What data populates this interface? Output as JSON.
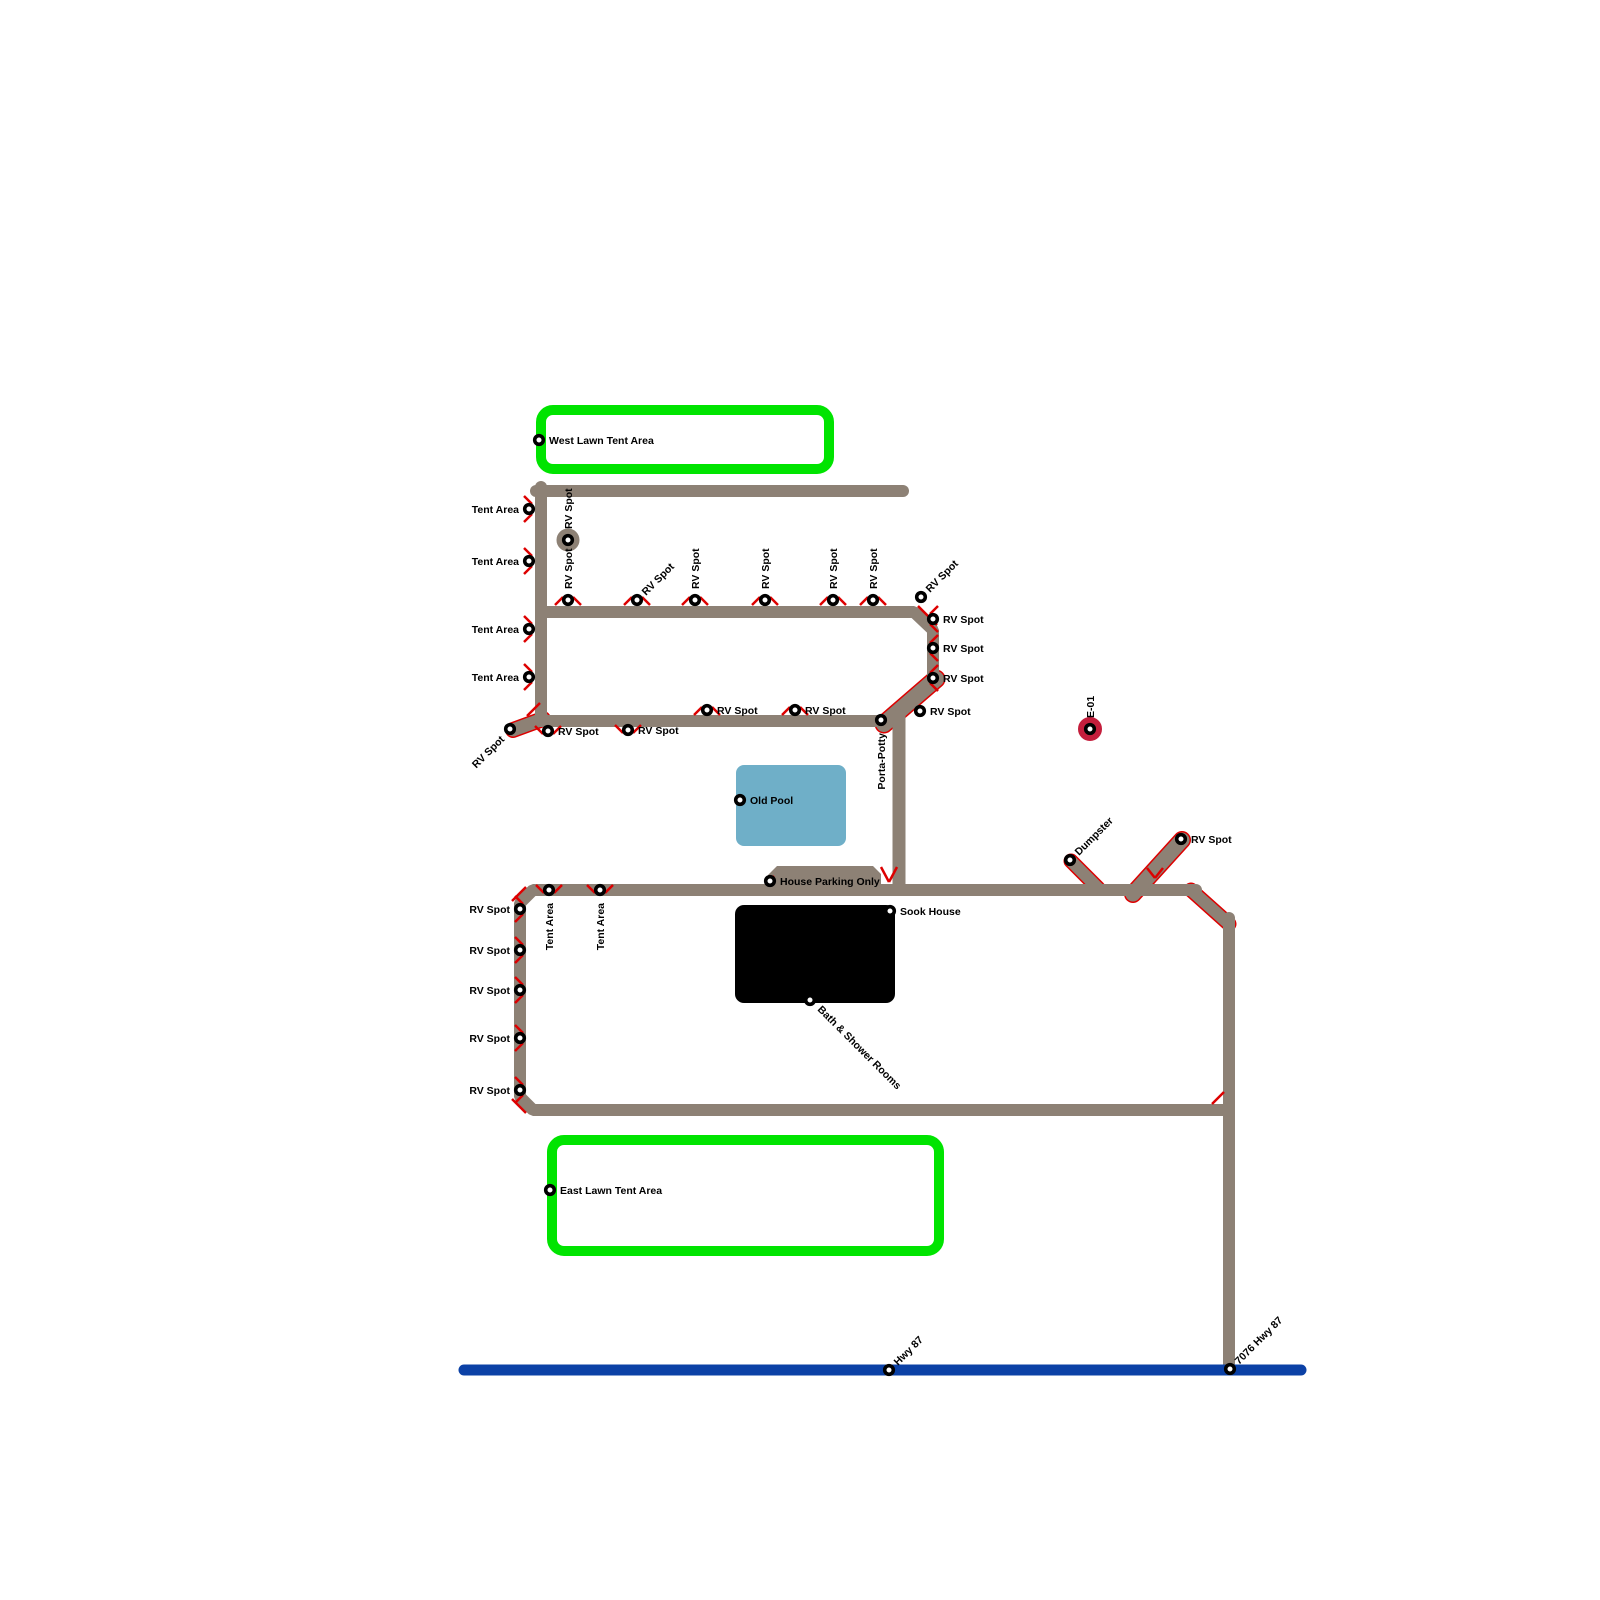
{
  "map": {
    "title": "Campground Site Map",
    "background": "#ffffff",
    "colors": {
      "road": "#8d8175",
      "casing": "#dd0000",
      "highway": "#0b41a6",
      "lawn_border": "#00e400",
      "lawn_fill": "#ffffff",
      "pool": "#6fafc8",
      "building": "#000000",
      "node_ring": "#000000",
      "node_fill": "#ffffff",
      "marker_red": "#c41e3c",
      "label": "#000000"
    },
    "label_font_px": 10.5,
    "areas": [
      {
        "name": "west-lawn-tent-area",
        "type": "lawn",
        "x": 541,
        "y": 410,
        "w": 288,
        "h": 59,
        "stroke_w": 10,
        "rx": 12
      },
      {
        "name": "east-lawn-tent-area",
        "type": "lawn",
        "x": 552,
        "y": 1140,
        "w": 387,
        "h": 111,
        "stroke_w": 10,
        "rx": 12
      },
      {
        "name": "old-pool",
        "type": "pool",
        "x": 736,
        "y": 765,
        "w": 110,
        "h": 81,
        "rx": 8
      },
      {
        "name": "sook-house-building",
        "type": "building",
        "x": 735,
        "y": 905,
        "w": 160,
        "h": 98,
        "rx": 9
      }
    ],
    "road_polys": [
      {
        "name": "house-parking-pad",
        "points": [
          [
            768,
            891
          ],
          [
            768,
            875
          ],
          [
            777,
            866
          ],
          [
            873,
            866
          ],
          [
            881,
            874
          ],
          [
            881,
            891
          ]
        ]
      }
    ],
    "roads": [
      {
        "name": "upper-top-road",
        "points": [
          [
            536,
            491
          ],
          [
            903,
            491
          ]
        ],
        "w": 12,
        "cased": false
      },
      {
        "name": "upper-left-road",
        "points": [
          [
            541,
            487
          ],
          [
            541,
            721
          ]
        ],
        "w": 12,
        "cased": false
      },
      {
        "name": "rv-row-road",
        "points": [
          [
            541,
            612
          ],
          [
            914,
            612
          ],
          [
            933,
            630
          ],
          [
            933,
            680
          ]
        ],
        "w": 12,
        "cased": false
      },
      {
        "name": "upper-bottom-road",
        "points": [
          [
            536,
            721
          ],
          [
            886,
            721
          ]
        ],
        "w": 12,
        "cased": false
      },
      {
        "name": "sw-stub-road",
        "points": [
          [
            543,
            719
          ],
          [
            513,
            730
          ]
        ],
        "w": 13,
        "cased": true
      },
      {
        "name": "porta-junction-diagonal",
        "points": [
          [
            884,
            724
          ],
          [
            936,
            679
          ]
        ],
        "w": 16,
        "cased": true
      },
      {
        "name": "porta-down-road",
        "points": [
          [
            899,
            716
          ],
          [
            899,
            889
          ]
        ],
        "w": 13,
        "cased": false
      },
      {
        "name": "lower-loop-road",
        "points": [
          [
            1196,
            890
          ],
          [
            533,
            890
          ],
          [
            520,
            903
          ],
          [
            520,
            1097
          ],
          [
            533,
            1110
          ],
          [
            1226,
            1110
          ]
        ],
        "w": 12,
        "cased": false
      },
      {
        "name": "east-corner-diagonal",
        "points": [
          [
            1191,
            890
          ],
          [
            1229,
            924
          ]
        ],
        "w": 12,
        "cased": true
      },
      {
        "name": "east-vertical-road",
        "points": [
          [
            1229,
            918
          ],
          [
            1229,
            1368
          ]
        ],
        "w": 12,
        "cased": false
      },
      {
        "name": "dumpster-spur",
        "points": [
          [
            1098,
            888
          ],
          [
            1071,
            861
          ]
        ],
        "w": 12,
        "cased": true
      },
      {
        "name": "rv-spur",
        "points": [
          [
            1133,
            894
          ],
          [
            1182,
            840
          ]
        ],
        "w": 15,
        "cased": true
      },
      {
        "name": "hwy-87-line",
        "points": [
          [
            464,
            1370
          ],
          [
            1301,
            1370
          ]
        ],
        "w": 11,
        "cased": false,
        "color": "highway"
      }
    ],
    "accents": [
      [
        [
          881,
          867
        ],
        [
          889,
          882
        ]
      ],
      [
        [
          889,
          882
        ],
        [
          897,
          867
        ]
      ],
      [
        [
          1147,
          868
        ],
        [
          1155,
          878
        ]
      ],
      [
        [
          1155,
          878
        ],
        [
          1163,
          868
        ]
      ],
      [
        [
          512,
          901
        ],
        [
          526,
          887
        ]
      ],
      [
        [
          512,
          1099
        ],
        [
          526,
          1113
        ]
      ],
      [
        [
          918,
          606
        ],
        [
          937,
          625
        ]
      ],
      [
        [
          1212,
          1104
        ],
        [
          1224,
          1092
        ]
      ],
      [
        [
          527,
          716
        ],
        [
          540,
          703
        ]
      ],
      [
        [
          766,
          884
        ],
        [
          774,
          876
        ]
      ]
    ],
    "nodes": [
      {
        "label": "West Lawn Tent Area",
        "x": 539,
        "y": 440,
        "lp": "right",
        "style": "default"
      },
      {
        "label": "Tent Area",
        "x": 529,
        "y": 509,
        "lp": "left",
        "style": "default",
        "ticks": "left"
      },
      {
        "label": "Tent Area",
        "x": 529,
        "y": 561,
        "lp": "left",
        "style": "default",
        "ticks": "left"
      },
      {
        "label": "Tent Area",
        "x": 529,
        "y": 629,
        "lp": "left",
        "style": "default",
        "ticks": "left"
      },
      {
        "label": "Tent Area",
        "x": 529,
        "y": 677,
        "lp": "left",
        "style": "default",
        "ticks": "left"
      },
      {
        "label": "RV Spot",
        "x": 568,
        "y": 540,
        "lp": "up",
        "style": "ring-road"
      },
      {
        "label": "RV Spot",
        "x": 568,
        "y": 600,
        "lp": "up",
        "style": "default",
        "ticks": "top"
      },
      {
        "label": "RV Spot",
        "x": 637,
        "y": 600,
        "lp": "diag-ur",
        "style": "default",
        "ticks": "top"
      },
      {
        "label": "RV Spot",
        "x": 695,
        "y": 600,
        "lp": "up",
        "style": "default",
        "ticks": "top"
      },
      {
        "label": "RV Spot",
        "x": 765,
        "y": 600,
        "lp": "up",
        "style": "default",
        "ticks": "top"
      },
      {
        "label": "RV Spot",
        "x": 833,
        "y": 600,
        "lp": "up",
        "style": "default",
        "ticks": "top"
      },
      {
        "label": "RV Spot",
        "x": 873,
        "y": 600,
        "lp": "up",
        "style": "default",
        "ticks": "top"
      },
      {
        "label": "RV Spot",
        "x": 921,
        "y": 597,
        "lp": "diag-ur",
        "style": "default"
      },
      {
        "label": "RV Spot",
        "x": 933,
        "y": 619,
        "lp": "right",
        "style": "default",
        "ticks": "right"
      },
      {
        "label": "RV Spot",
        "x": 933,
        "y": 648,
        "lp": "right",
        "style": "default",
        "ticks": "right"
      },
      {
        "label": "RV Spot",
        "x": 933,
        "y": 678,
        "lp": "right",
        "style": "default",
        "ticks": "right"
      },
      {
        "label": "RV Spot",
        "x": 920,
        "y": 711,
        "lp": "right",
        "style": "default"
      },
      {
        "label": "RV Spot",
        "x": 795,
        "y": 710,
        "lp": "right",
        "style": "default",
        "ticks": "top"
      },
      {
        "label": "RV Spot",
        "x": 707,
        "y": 710,
        "lp": "right",
        "style": "default",
        "ticks": "top"
      },
      {
        "label": "Porta-Potty",
        "x": 881,
        "y": 720,
        "lp": "down",
        "style": "default"
      },
      {
        "label": "RV Spot",
        "x": 628,
        "y": 730,
        "lp": "right",
        "style": "default",
        "ticks": "bottom"
      },
      {
        "label": "RV Spot",
        "x": 548,
        "y": 731,
        "lp": "right",
        "style": "default",
        "ticks": "bottom"
      },
      {
        "label": "RV Spot",
        "x": 510,
        "y": 729,
        "lp": "diag-dl",
        "style": "default"
      },
      {
        "label": "E-01",
        "x": 1090,
        "y": 729,
        "lp": "up",
        "style": "ring-red"
      },
      {
        "label": "Old Pool",
        "x": 740,
        "y": 800,
        "lp": "right",
        "style": "default"
      },
      {
        "label": "House Parking Only",
        "x": 770,
        "y": 881,
        "lp": "right",
        "style": "default"
      },
      {
        "label": "Tent Area",
        "x": 549,
        "y": 890,
        "lp": "down",
        "style": "default",
        "ticks": "bottom"
      },
      {
        "label": "Tent Area",
        "x": 600,
        "y": 890,
        "lp": "down",
        "style": "default",
        "ticks": "bottom"
      },
      {
        "label": "RV Spot",
        "x": 520,
        "y": 909,
        "lp": "left",
        "style": "default",
        "ticks": "left"
      },
      {
        "label": "RV Spot",
        "x": 520,
        "y": 950,
        "lp": "left",
        "style": "default",
        "ticks": "left"
      },
      {
        "label": "RV Spot",
        "x": 520,
        "y": 990,
        "lp": "left",
        "style": "default",
        "ticks": "left"
      },
      {
        "label": "RV Spot",
        "x": 520,
        "y": 1038,
        "lp": "left",
        "style": "default",
        "ticks": "left"
      },
      {
        "label": "RV Spot",
        "x": 520,
        "y": 1090,
        "lp": "left",
        "style": "default",
        "ticks": "left"
      },
      {
        "label": "Sook House",
        "x": 890,
        "y": 911,
        "lp": "right",
        "style": "default"
      },
      {
        "label": "Bath & Shower Rooms",
        "x": 810,
        "y": 1000,
        "lp": "diag-dr",
        "style": "default"
      },
      {
        "label": "Dumpster",
        "x": 1070,
        "y": 860,
        "lp": "diag-ur",
        "style": "default"
      },
      {
        "label": "RV Spot",
        "x": 1181,
        "y": 839,
        "lp": "right",
        "style": "default"
      },
      {
        "label": "East Lawn Tent Area",
        "x": 550,
        "y": 1190,
        "lp": "right",
        "style": "default"
      },
      {
        "label": "Hwy 87",
        "x": 889,
        "y": 1370,
        "lp": "diag-ur",
        "style": "default"
      },
      {
        "label": "7076 Hwy 87",
        "x": 1230,
        "y": 1369,
        "lp": "diag-ur",
        "style": "default"
      }
    ]
  }
}
